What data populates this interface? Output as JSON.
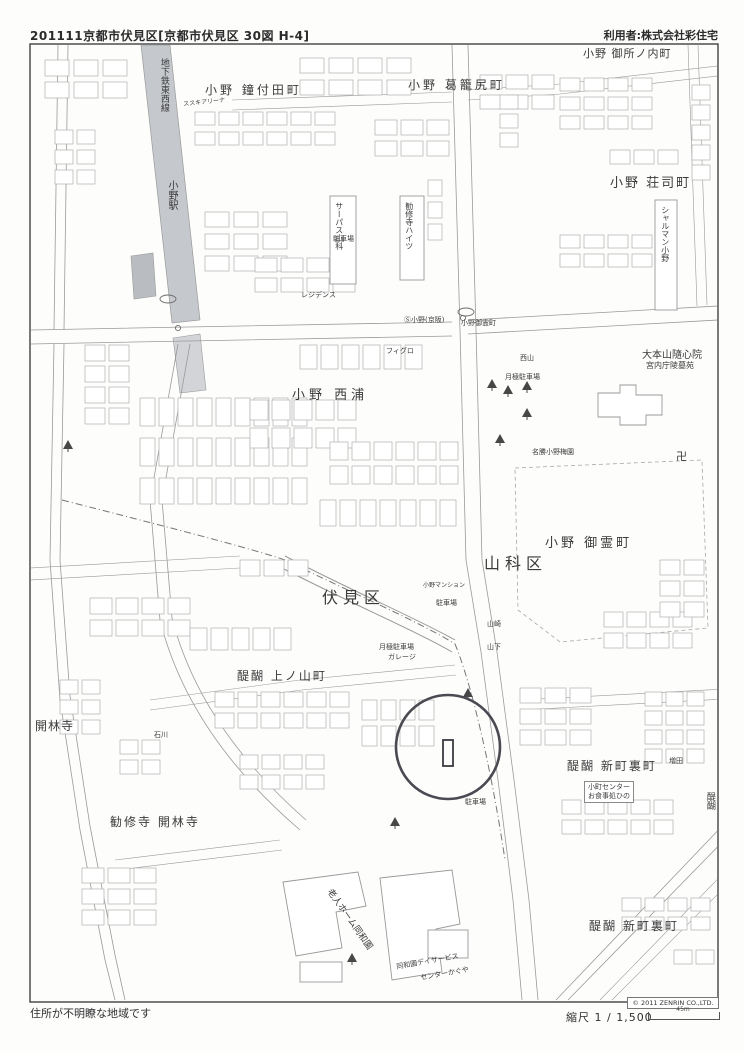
{
  "header": {
    "left": "201111京都市伏見区[京都市伏見区 30図 H-4]",
    "right": "利用者:株式会社彩住宅"
  },
  "footer": {
    "note": "住所が不明瞭な地域です",
    "copyright": "© 2011 ZENRIN CO.,LTD.",
    "scale_label": "縮尺 1 / 1,500",
    "scale_distance": "45m"
  },
  "map": {
    "colors": {
      "subway_band": "#c5c8cc",
      "road": "#9a9a9a",
      "building": "#b0b0b0",
      "marker": "#4a4a52",
      "frame": "#333333"
    },
    "marker": {
      "x": 448,
      "y": 747,
      "r": 52,
      "target": {
        "x": 443,
        "y": 740,
        "w": 10,
        "h": 26
      }
    },
    "labels": [
      {
        "name": "district-ono-kanetsukiden",
        "text": "小野 鐘付田町",
        "x": 205,
        "y": 84,
        "size": 12,
        "spacing": 3
      },
      {
        "name": "district-ono-tsuzurajiri",
        "text": "小野 葛籠尻町",
        "x": 408,
        "y": 79,
        "size": 12,
        "spacing": 3
      },
      {
        "name": "district-ono-goshonouchi",
        "text": "小野 御所ノ内町",
        "x": 583,
        "y": 48,
        "size": 11,
        "spacing": 1
      },
      {
        "name": "district-ono-shoji",
        "text": "小野 荘司町",
        "x": 610,
        "y": 177,
        "size": 13,
        "spacing": 2
      },
      {
        "name": "district-ono-nishiura",
        "text": "小野 西浦",
        "x": 292,
        "y": 389,
        "size": 13,
        "spacing": 4
      },
      {
        "name": "district-ono-goryocho",
        "text": "小野 御霊町",
        "x": 545,
        "y": 537,
        "size": 13,
        "spacing": 3
      },
      {
        "name": "ward-yamashina",
        "text": "山科区",
        "x": 484,
        "y": 555,
        "size": 16,
        "spacing": 5
      },
      {
        "name": "ward-fushimi",
        "text": "伏見区",
        "x": 322,
        "y": 589,
        "size": 16,
        "spacing": 5
      },
      {
        "name": "district-daigo-uenoyama",
        "text": "醍醐 上ノ山町",
        "x": 237,
        "y": 670,
        "size": 12,
        "spacing": 2
      },
      {
        "name": "temple-kairinji",
        "text": "開林寺",
        "x": 35,
        "y": 720,
        "size": 12,
        "spacing": 1
      },
      {
        "name": "district-kanshuji-kairinji",
        "text": "勧修寺 開林寺",
        "x": 110,
        "y": 816,
        "size": 12,
        "spacing": 2
      },
      {
        "name": "district-daigo-shinmachiura-1",
        "text": "醍醐 新町裏町",
        "x": 567,
        "y": 760,
        "size": 12,
        "spacing": 2
      },
      {
        "name": "district-daigo-shinmachiura-2",
        "text": "醍醐 新町裏町",
        "x": 589,
        "y": 920,
        "size": 12,
        "spacing": 2
      },
      {
        "name": "temple-zuishinin",
        "text": "大本山隨心院",
        "x": 642,
        "y": 350,
        "size": 10
      },
      {
        "name": "zuishinin-sub-label",
        "text": "宮内庁陵墓苑",
        "x": 646,
        "y": 362,
        "size": 8
      },
      {
        "name": "ono-baien",
        "text": "名勝小野梅園",
        "x": 532,
        "y": 449,
        "size": 7
      },
      {
        "name": "subway-line-label",
        "text": "地下鉄東西線",
        "x": 158,
        "y": 58,
        "size": 9,
        "vertical": true
      },
      {
        "name": "station-ono-label",
        "text": "小野駅",
        "x": 166,
        "y": 180,
        "size": 10,
        "vertical": true
      },
      {
        "name": "bldg-surpass-yamashina",
        "text": "サーパス山科",
        "x": 334,
        "y": 202,
        "size": 8,
        "vertical": true
      },
      {
        "name": "bldg-kanshuji-heights",
        "text": "勧修寺ハイツ",
        "x": 404,
        "y": 202,
        "size": 8,
        "vertical": true
      },
      {
        "name": "bldg-charmant-ono",
        "text": "シャルマン小野",
        "x": 660,
        "y": 206,
        "size": 8,
        "vertical": true
      },
      {
        "name": "parking-tsukigime-1",
        "text": "月極駐車場",
        "x": 505,
        "y": 374,
        "size": 7
      },
      {
        "name": "parking-tsukigime-2",
        "text": "月極駐車場",
        "x": 379,
        "y": 644,
        "size": 7
      },
      {
        "name": "parking-garage",
        "text": "ガレージ",
        "x": 388,
        "y": 654,
        "size": 7
      },
      {
        "name": "parking-1",
        "text": "駐車場",
        "x": 436,
        "y": 600,
        "size": 7
      },
      {
        "name": "parking-2",
        "text": "駐車場",
        "x": 465,
        "y": 799,
        "size": 7
      },
      {
        "name": "parking-3",
        "text": "駐車場",
        "x": 333,
        "y": 236,
        "size": 7
      },
      {
        "name": "bldg-ono-mansion",
        "text": "小野マンション",
        "x": 423,
        "y": 583,
        "size": 6
      },
      {
        "name": "busstop-ono-keihan",
        "text": "Ⓢ小野(京阪)",
        "x": 404,
        "y": 317,
        "size": 7
      },
      {
        "name": "intersection-ono-goryocho",
        "text": "小野御霊町",
        "x": 461,
        "y": 320,
        "size": 7
      },
      {
        "name": "bldg-figuro",
        "text": "フィグロ",
        "x": 386,
        "y": 348,
        "size": 7
      },
      {
        "name": "bldg-residence",
        "text": "レジデンス",
        "x": 301,
        "y": 292,
        "size": 7
      },
      {
        "name": "douwaen-home",
        "text": "老人ホーム同和園",
        "x": 332,
        "y": 888,
        "size": 9,
        "rot": 55
      },
      {
        "name": "douwaen-dayservice-1",
        "text": "同和園デイサービス",
        "x": 396,
        "y": 964,
        "size": 7,
        "rot": -10
      },
      {
        "name": "douwaen-dayservice-2",
        "text": "センターかぐや",
        "x": 420,
        "y": 975,
        "size": 7,
        "rot": -10
      },
      {
        "name": "manji-temple-icon",
        "text": "卍",
        "x": 676,
        "y": 451,
        "size": 11
      },
      {
        "name": "house-yamazaki",
        "text": "山崎",
        "x": 487,
        "y": 621,
        "size": 7
      },
      {
        "name": "house-yamashita",
        "text": "山下",
        "x": 487,
        "y": 644,
        "size": 7
      },
      {
        "name": "house-ishikawa",
        "text": "石川",
        "x": 154,
        "y": 732,
        "size": 7
      },
      {
        "name": "house-masuda",
        "text": "増田",
        "x": 669,
        "y": 758,
        "size": 7
      },
      {
        "name": "house-nishiyama",
        "text": "西山",
        "x": 520,
        "y": 355,
        "size": 7
      },
      {
        "name": "suzuki-arena",
        "text": "ススキアリーナ",
        "x": 183,
        "y": 102,
        "size": 6,
        "rot": -6
      },
      {
        "name": "daigo-edge-label",
        "text": "醍醐",
        "x": 704,
        "y": 792,
        "size": 9,
        "vertical": true
      },
      {
        "name": "komachi-center",
        "lines": [
          "小町センター",
          "お食事処ひの"
        ],
        "x": 584,
        "y": 781,
        "size": 7,
        "box": true
      }
    ]
  }
}
